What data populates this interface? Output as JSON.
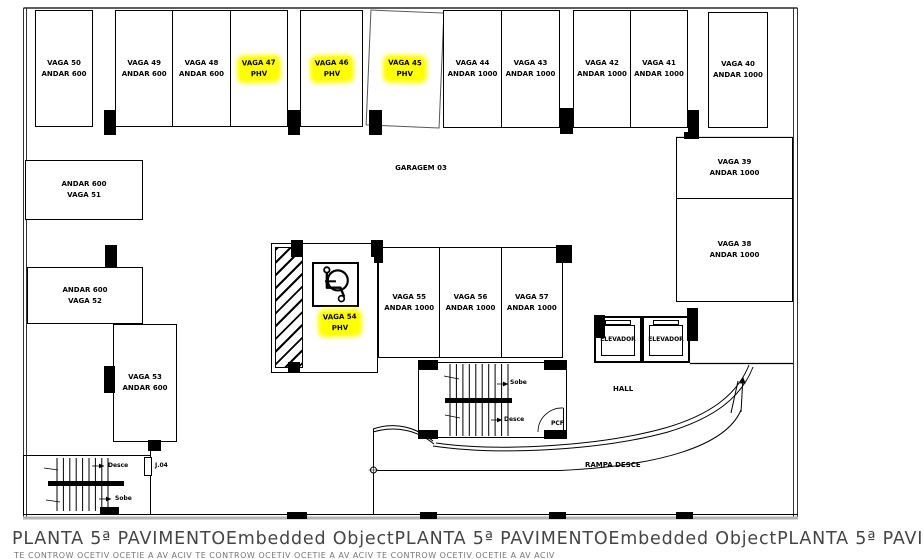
{
  "colors": {
    "highlight": "#ffff00",
    "line": "#000000",
    "caption": "#454545"
  },
  "plan": {
    "garage_label": "GARAGEM 03",
    "hall_label": "HALL",
    "ramp_label": "RAMPA DESCE",
    "pcf_label": "PCF",
    "j04_label": "J.04",
    "elevators": [
      {
        "label": "ELEVADOR"
      },
      {
        "label": "ELEVADOR"
      }
    ],
    "stairs_main": {
      "up": "Sobe",
      "down": "Desce"
    },
    "stairs_left": {
      "up": "Sobe",
      "down": "Desce"
    }
  },
  "stalls": {
    "top": [
      {
        "line1": "VAGA 50",
        "line2": "ANDAR 600",
        "phv": false
      },
      {
        "line1": "VAGA 49",
        "line2": "ANDAR 600",
        "phv": false
      },
      {
        "line1": "VAGA 48",
        "line2": "ANDAR 600",
        "phv": false
      },
      {
        "line1": "VAGA 47",
        "line2": "PHV",
        "phv": true
      },
      {
        "line1": "VAGA 46",
        "line2": "PHV",
        "phv": true
      },
      {
        "line1": "VAGA 45",
        "line2": "PHV",
        "phv": true
      },
      {
        "line1": "VAGA 44",
        "line2": "ANDAR 1000",
        "phv": false
      },
      {
        "line1": "VAGA 43",
        "line2": "ANDAR 1000",
        "phv": false
      },
      {
        "line1": "VAGA 42",
        "line2": "ANDAR 1000",
        "phv": false
      },
      {
        "line1": "VAGA 41",
        "line2": "ANDAR 1000",
        "phv": false
      },
      {
        "line1": "VAGA 40",
        "line2": "ANDAR 1000",
        "phv": false
      }
    ],
    "left": [
      {
        "line1": "ANDAR 600",
        "line2": "VAGA 51"
      },
      {
        "line1": "ANDAR 600",
        "line2": "VAGA 52"
      },
      {
        "line1": "VAGA 53",
        "line2": "ANDAR 600"
      }
    ],
    "right": [
      {
        "line1": "VAGA 39",
        "line2": "ANDAR 1000"
      },
      {
        "line1": "VAGA 38",
        "line2": "ANDAR 1000"
      }
    ],
    "center": [
      {
        "line1": "VAGA 54",
        "line2": "PHV",
        "phv": true
      },
      {
        "line1": "VAGA 55",
        "line2": "ANDAR 1000",
        "phv": false
      },
      {
        "line1": "VAGA 56",
        "line2": "ANDAR 1000",
        "phv": false
      },
      {
        "line1": "VAGA 57",
        "line2": "ANDAR 1000",
        "phv": false
      }
    ]
  },
  "caption": {
    "line1": "PLANTA 5ª PAVIMENTOEmbedded ObjectPLANTA 5ª PAVIMENTOEmbedded ObjectPLANTA 5ª PAVIMENTO",
    "line2_partial": "TE CONTROW OCETIV OCETIE A AV ACIV TE CONTROW OCETIV OCETIE A AV ACIV TE CONTROW OCETIV OCETIE A AV ACIV"
  }
}
